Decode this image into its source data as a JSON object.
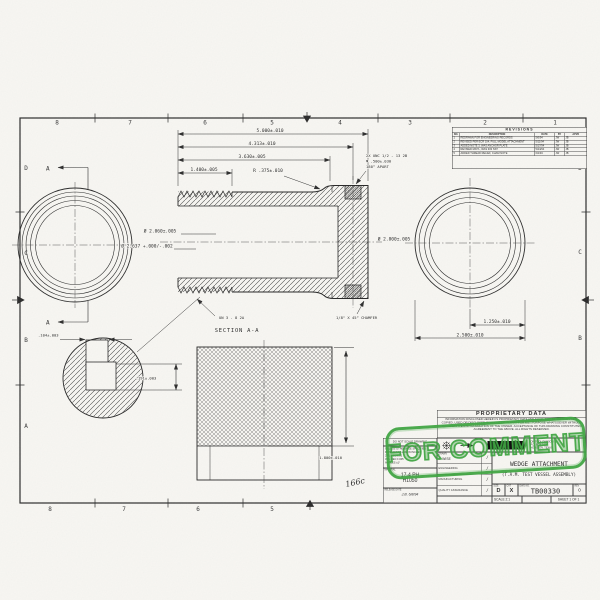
{
  "stamp": {
    "label": "FOR COMMENT",
    "color": "#3ba43e"
  },
  "handwritten_note": "166c",
  "sheet": {
    "zones_top": [
      "8",
      "7",
      "6",
      "5",
      "4",
      "3",
      "2",
      "1"
    ],
    "zones_bottom": [
      "8",
      "7",
      "6",
      "5"
    ],
    "zones_left": [
      "D",
      "C",
      "B",
      "A"
    ],
    "zones_right": [
      "D",
      "C",
      "B"
    ]
  },
  "revisions": {
    "title": "REVISIONS",
    "columns": [
      "NO.",
      "DESCRIPTION",
      "DATE",
      "BY",
      "APVD"
    ],
    "rows": [
      {
        "no": "1",
        "desc": "REDRAWN FOR ENGINEERING RECORDS",
        "date": "5/6/94",
        "by": "JW",
        "apvd": "JB"
      },
      {
        "no": "2",
        "desc": "REVISED PER ECR 104, FULL MODEL ATTACHMENT",
        "date": "5/11/94",
        "by": "JW",
        "apvd": "JB"
      },
      {
        "no": "3",
        "desc": "ADDED NOTE 3, WAS ANCHOR PLATE",
        "date": "5/17/94",
        "by": "JW",
        "apvd": "JB"
      },
      {
        "no": "4",
        "desc": "REVISED MAT'L, WAS 303 SST",
        "date": "5/24/94",
        "by": "JW",
        "apvd": "JB"
      },
      {
        "no": "5",
        "desc": "ADDED THREAD RELIEF, CHAM NOTE",
        "date": "6/2/94",
        "by": "JW",
        "apvd": "JB"
      }
    ]
  },
  "views": {
    "section": {
      "label": "SECTION  A-A",
      "cut_label": "A",
      "dims": {
        "len_overall": "5.000±.010",
        "len_to_holes": "4.313±.010",
        "len_to_flange": "3.630±.005",
        "len_thread": "1.400±.005",
        "radius": "R .375±.010",
        "bore": "Ø 2.060±.005",
        "body_od": "Ø 2.637 +.000/-.002",
        "flange_od": "Ø 2.800±.005"
      },
      "notes": {
        "holes_1": "2X UNC 1/2 - 13  2B",
        "holes_2": "▼ .500±.030",
        "holes_3": "180° APART",
        "thread": "UN 3 - 8 2A",
        "chamfer": "1/8\" X 45° CHAMFER"
      }
    },
    "end_view": {
      "dim_half": "1.250±.010",
      "dim_full": "2.500±.010"
    },
    "detail": {
      "dim_width": ".104±.003",
      "dim_depth": ".191±.003"
    },
    "side_view": {
      "dim_thread_len": "1.800±.010"
    }
  },
  "title_block": {
    "proprietary_title": "PROPRIETARY DATA",
    "proprietary_text": "INFORMATION DISCLOSED HEREIN IS PROPRIETARY DATA AND SHALL NOT BE REPRODUCED, COPIED, USED OR DISCLOSED IN WHOLE OR IN PART FOR ANY PURPOSE WHATSOEVER WITHOUT PRIOR WRITTEN AUTHORIZATION OF THE OWNER. ACCEPTANCE OF THIS DRAWING CONSTITUTES AGREEMENT TO THE ABOVE. ALL RIGHTS RESERVED.",
    "address_1": "OIL TOOL DIVISION",
    "address_2": "P.O. BOX 1474",
    "address_3": "HOUSTON, TEXAS",
    "do_not_scale": "DO NOT SCALE DRAWING",
    "tol_header1": "UNLESS OTHERWISE SPECIFIED",
    "tol_header2": "DIMENSIONS ARE IN INCHES",
    "tol_2pl": "2 PL DEC ±.01",
    "tol_3pl": "3 PL DEC ±.005",
    "tol_angles": "ANGLES ±1°",
    "material_label": "MATERIAL",
    "material_value1": "17-4 PH",
    "material_value2": "H1050",
    "release_label": "RELEASE DATE",
    "release_value": "J.B.   6/8/94",
    "drawn_label": "DRAWN",
    "drawn_value": "J. WISE",
    "sig_engineering": "ENGINEERING",
    "sig_manufacturing": "MANUFACTURING",
    "sig_quality": "QUALITY ASSURANCE",
    "sig_mark": "/",
    "title_label": "TITLE",
    "title_line1": "WEDGE ATTACHMENT",
    "title_line2": "(T.A.M. TEST VESSEL ASSEMBLY)",
    "size_label": "SIZE",
    "size_value": "D",
    "cat_label": "CAT",
    "cat_value": "X",
    "dwg_label": "DWG NO.",
    "dwg_value": "TB00330",
    "rev_label": "REV",
    "rev_value": "0",
    "scale_text": "SCALE 2:1",
    "sheet_text": "SHEET 1 OF 1"
  }
}
